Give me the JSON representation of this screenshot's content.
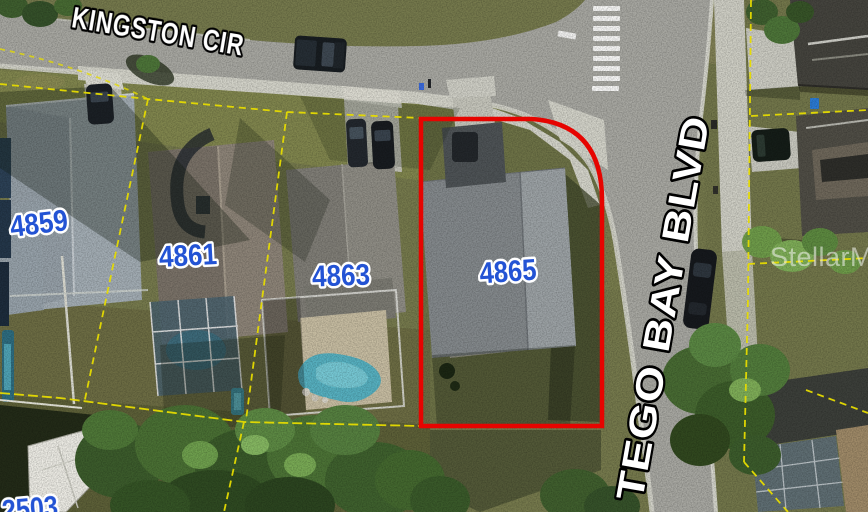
{
  "map": {
    "description": "Aerial parcel map with highlighted lot",
    "streets": {
      "kingston": {
        "label": "KINGSTON CIR"
      },
      "tego_bay": {
        "label": "TEGO BAY BLVD"
      }
    },
    "parcels": {
      "p4859": {
        "number": "4859"
      },
      "p4861": {
        "number": "4861"
      },
      "p4863": {
        "number": "4863"
      },
      "p4865": {
        "number": "4865",
        "highlighted": true
      },
      "p2503": {
        "number": "2503",
        "partially_visible": true
      }
    },
    "watermark": {
      "label": "StellarMLS"
    },
    "colors": {
      "highlight_outline": "#e60400",
      "parcel_line": "#e6dc00",
      "house_number_fill": "#2353d4",
      "house_number_stroke": "#ffffff",
      "street_label_fill": "#ffffff",
      "street_label_stroke": "#000000",
      "road": "#a8a8a2",
      "grass": "#767a4d",
      "pool_water": "#57b1c1"
    }
  }
}
